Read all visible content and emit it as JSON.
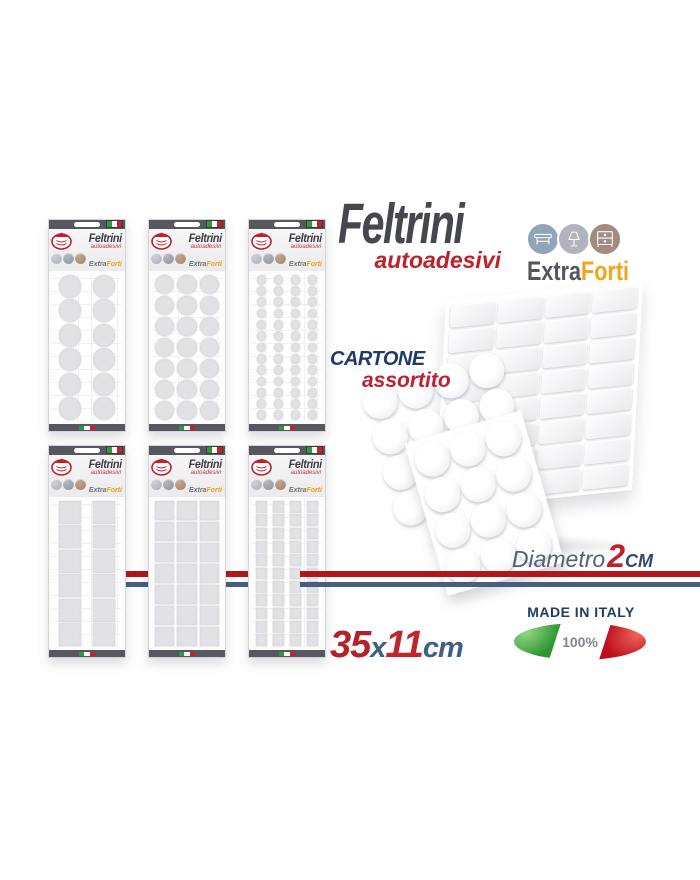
{
  "title": {
    "main": "Feltrini",
    "sub": "autoadesivi"
  },
  "extraforti": {
    "extra": "Extra",
    "forti": "Forti"
  },
  "category_icons": [
    "table-icon",
    "lamp-icon",
    "dresser-icon"
  ],
  "cartone": {
    "line1": "CARTONE",
    "line2": "assortito"
  },
  "diametro": {
    "label": "Diametro",
    "value": "2",
    "unit": "CM"
  },
  "dimensions": {
    "width": "35",
    "times": "x",
    "height": "11",
    "unit": "cm"
  },
  "made_in_italy": {
    "label": "MADE IN ITALY",
    "percent": "100%"
  },
  "package_card": {
    "title": "Feltrini",
    "subtitle": "autoadesivi",
    "extra": "Extra",
    "forti": "Forti"
  },
  "packages": [
    {
      "shape": "circle",
      "cols": 2,
      "rows": 6
    },
    {
      "shape": "circle",
      "cols": 3,
      "rows": 7
    },
    {
      "shape": "circle",
      "cols": 4,
      "rows": 13
    },
    {
      "shape": "square",
      "cols": 2,
      "rows": 6
    },
    {
      "shape": "square",
      "cols": 3,
      "rows": 7
    },
    {
      "shape": "square",
      "cols": 4,
      "rows": 11
    }
  ],
  "pile": {
    "square_sheet": {
      "cols": 4,
      "rows": 8
    },
    "round_back": {
      "cols": 4,
      "rows": 4
    },
    "round_front": {
      "cols": 3,
      "rows": 4
    }
  },
  "colors": {
    "title_gray": "#45464e",
    "brand_red": "#c1202a",
    "orange": "#f0a31b",
    "navy": "#1f3a6a",
    "steel": "#3f5f88",
    "stripe_red": "#b0161c",
    "stripe_blue": "#44607e",
    "circle1": "#92a4b7",
    "circle2": "#b2b4bd",
    "circle3": "#a28b82"
  }
}
